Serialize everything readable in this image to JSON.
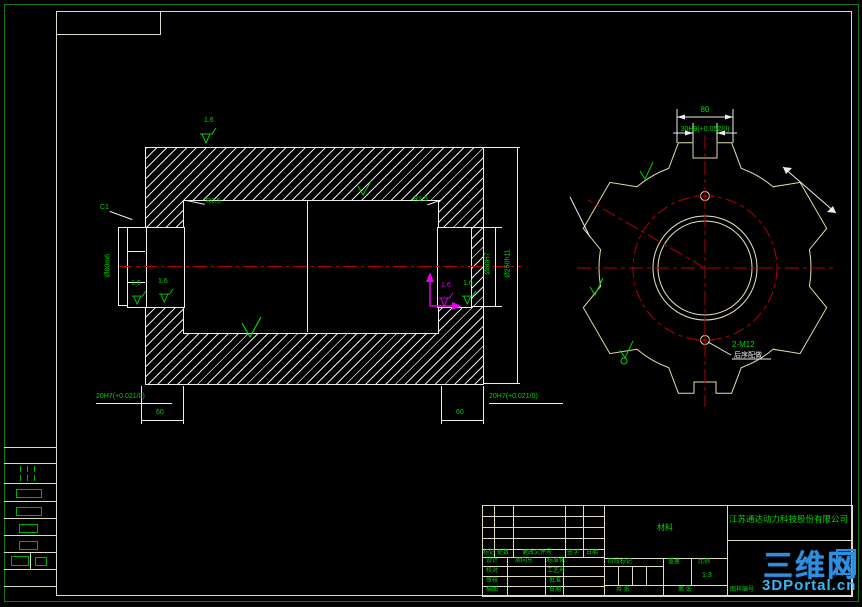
{
  "left_view": {
    "roughness_top": "1.6",
    "roughness_left_a": "1.6",
    "roughness_left_b": "1.6",
    "roughness_magenta": "1.6",
    "roughness_right": "1.6",
    "fillet_left": "R0.5",
    "fillet_right": "R1.5",
    "chamfer": "C1",
    "dia_hub": "Ø80m6",
    "dia_bore": "Ø80H7",
    "dia_outer": "Ø250h11",
    "keyway_left": "20H7(+0.021/0)",
    "keyway_right": "20H7(+0.021/0)",
    "length_left": "60",
    "length_right": "60"
  },
  "right_view": {
    "width_top": "80",
    "slot": "30H9(+0.052/0)",
    "holes": "2-M12",
    "holes_note": "后序配做"
  },
  "title_block": {
    "company": "江苏通达动力科技股份有限公司",
    "material": "材料",
    "rev_headers": [
      "标记",
      "处数",
      "更改文件号",
      "签字",
      "日期"
    ],
    "rows": [
      {
        "a": "设计",
        "b": "周向东",
        "c": "标准化"
      },
      {
        "a": "校对",
        "b": "",
        "c": "工艺号"
      },
      {
        "a": "审核",
        "b": "",
        "c": "批准"
      },
      {
        "a": "描图",
        "b": "",
        "c": "日期"
      }
    ],
    "stage_label": "阶段标记",
    "weight_label": "重量",
    "scale_label": "比例",
    "scale_value": "1:3",
    "sheet_total": "共  张",
    "sheet_no": "第  张",
    "doc_no_label": "图样编号"
  },
  "watermark": {
    "name": "三维网",
    "badge": "技术",
    "site": "3DPortal.cn"
  }
}
